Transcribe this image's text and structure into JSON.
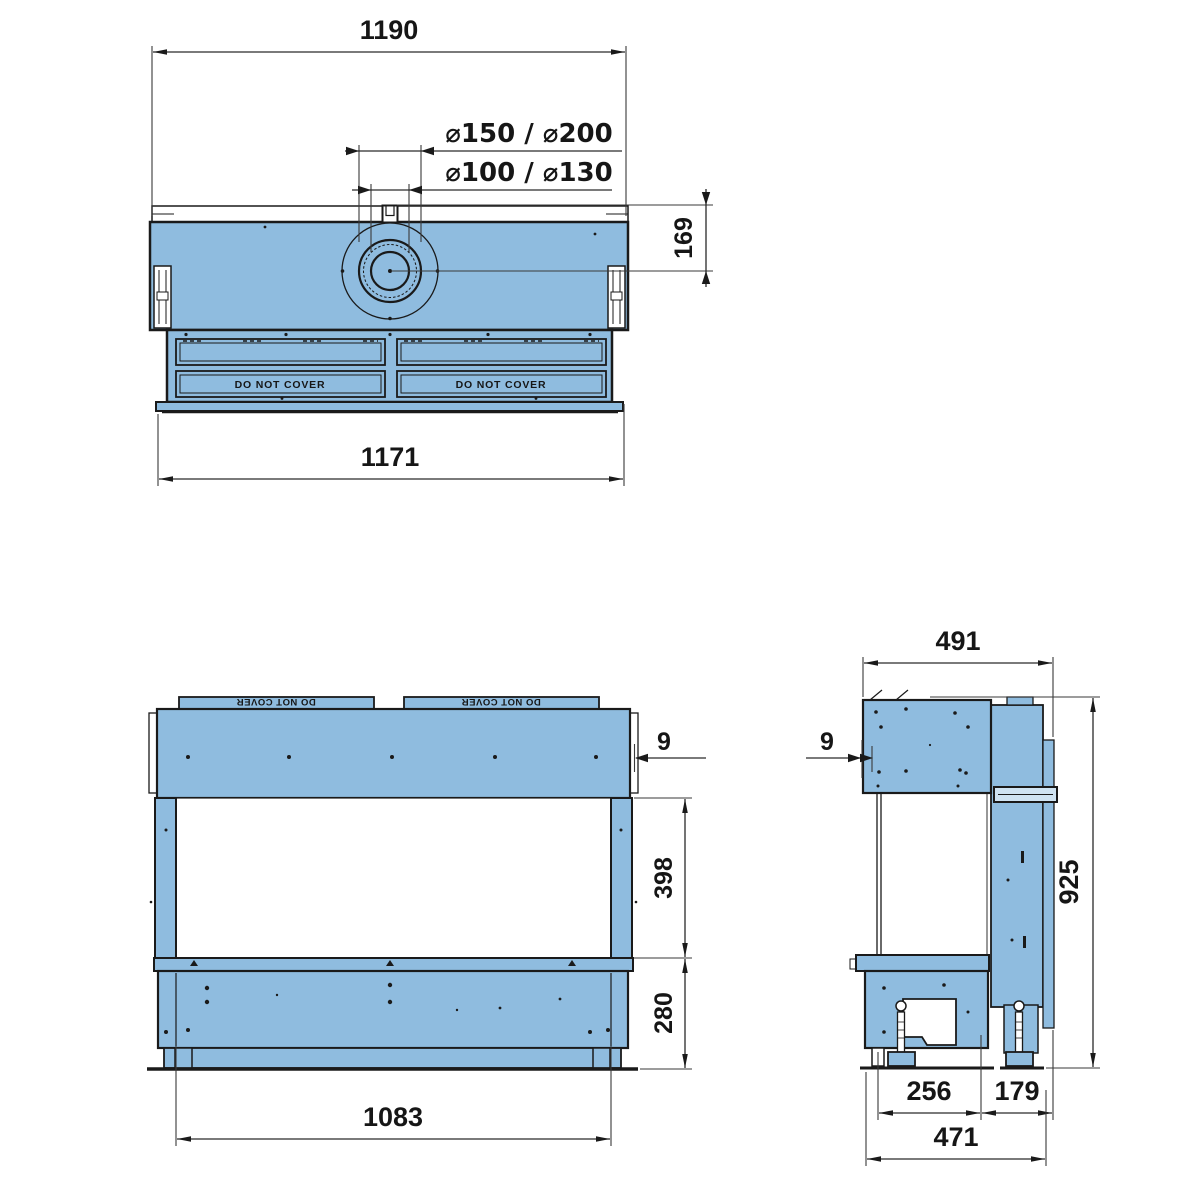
{
  "drawing": {
    "type": "technical-drawing",
    "subject": "fireplace insert - three orthographic views with dimensions (mm)",
    "colors": {
      "body": "#8fbcdf",
      "body_light": "#cfe3f2",
      "line": "#1a1a1a",
      "dim_line": "#3a3a3a",
      "text": "#161616"
    },
    "top_view": {
      "dim_overall_width": "1190",
      "dim_flue_outer": "⌀150 / ⌀200",
      "dim_flue_inner": "⌀100 / ⌀130",
      "dim_flue_offset": "169",
      "dim_body_width": "1171",
      "grille_left_label": "DO NOT COVER",
      "grille_right_label": "DO NOT COVER"
    },
    "front_view": {
      "dim_frame_thickness": "9",
      "dim_glass_height": "398",
      "dim_base_height": "280",
      "dim_glass_width": "1083",
      "grille_left_label": "DO NOT COVER",
      "grille_right_label": "DO NOT COVER"
    },
    "side_view": {
      "dim_top_depth": "491",
      "dim_frame_thickness": "9",
      "dim_overall_height": "925",
      "dim_firebox_depth": "256",
      "dim_back_depth": "179",
      "dim_base_depth": "471"
    }
  }
}
